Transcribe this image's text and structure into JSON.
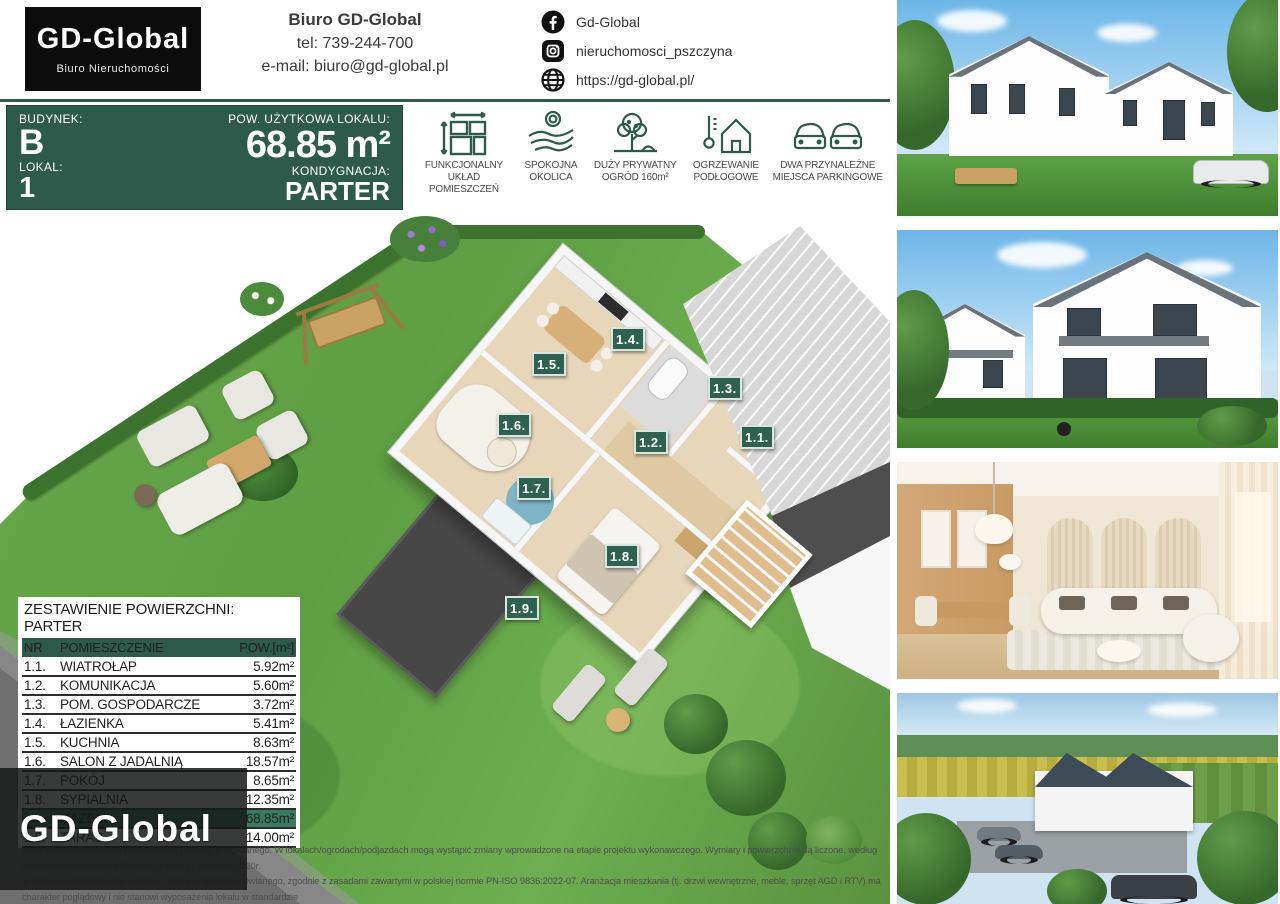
{
  "colors": {
    "brand_green": "#2d5a4a",
    "badge_green": "#2f6150",
    "total_row_green": "#3a7a5f",
    "logo_black": "#0c0c0c"
  },
  "header": {
    "logo": {
      "title": "GD-Global",
      "subtitle": "Biuro Nieruchomości"
    },
    "contact": {
      "company": "Biuro GD-Global",
      "phone": "tel: 739-244-700",
      "email": "e-mail: biuro@gd-global.pl"
    },
    "social": [
      {
        "icon": "facebook-icon",
        "label": "Gd-Global"
      },
      {
        "icon": "instagram-icon",
        "label": "nieruchomosci_pszczyna"
      },
      {
        "icon": "globe-icon",
        "label": "https://gd-global.pl/"
      }
    ]
  },
  "banner": {
    "budynek_label": "BUDYNEK:",
    "budynek_value": "B",
    "lokal_label": "LOKAL:",
    "lokal_value": "1",
    "pow_label": "POW. UŻYTKOWA LOKALU:",
    "pow_value": "68.85 m²",
    "kondygnacja_label": "KONDYGNACJA:",
    "kondygnacja_value": "PARTER"
  },
  "features": [
    {
      "icon": "floor-plan-icon",
      "label": "FUNKCJONALNY\nUKŁAD POMIESZCZEŃ"
    },
    {
      "icon": "calm-area-icon",
      "label": "SPOKOJNA\nOKOLICA"
    },
    {
      "icon": "garden-tree-icon",
      "label": "DUŻY PRYWATNY\nOGRÓD 160m²"
    },
    {
      "icon": "floor-heating-icon",
      "label": "OGRZEWANIE\nPODŁOGOWE"
    },
    {
      "icon": "parking-icon",
      "label": "DWA PRZYNALEŻNE\nMIEJSCA PARKINGOWE"
    }
  ],
  "floorplan": {
    "badges": [
      {
        "label": "1.1.",
        "x": 757,
        "y": 221
      },
      {
        "label": "1.2.",
        "x": 651,
        "y": 226
      },
      {
        "label": "1.3.",
        "x": 725,
        "y": 172
      },
      {
        "label": "1.4.",
        "x": 628,
        "y": 123
      },
      {
        "label": "1.5.",
        "x": 549,
        "y": 148
      },
      {
        "label": "1.6.",
        "x": 514,
        "y": 209
      },
      {
        "label": "1.7.",
        "x": 534,
        "y": 272
      },
      {
        "label": "1.8.",
        "x": 622,
        "y": 340
      },
      {
        "label": "1.9.",
        "x": 522,
        "y": 392
      }
    ]
  },
  "area_table": {
    "title": "ZESTAWIENIE POWIERZCHNI: PARTER",
    "headers": [
      "NR",
      "POMIESZCZENIE",
      "POW.[m²]"
    ],
    "rows": [
      [
        "1.1.",
        "WIATROŁAP",
        "5.92m²"
      ],
      [
        "1.2.",
        "KOMUNIKACJA",
        "5.60m²"
      ],
      [
        "1.3.",
        "POM. GOSPODARCZE",
        "3.72m²"
      ],
      [
        "1.4.",
        "ŁAZIENKA",
        "5.41m²"
      ],
      [
        "1.5.",
        "KUCHNIA",
        "8.63m²"
      ],
      [
        "1.6.",
        "SALON Z JADALNIĄ",
        "18.57m²"
      ],
      [
        "1.7.",
        "POKÓJ",
        "8.65m²"
      ],
      [
        "1.8.",
        "SYPIALNIA",
        "12.35m²"
      ]
    ],
    "total_row": [
      "",
      "RAZEM",
      "68.85m²"
    ],
    "extra_row": [
      "1.9.",
      "TARAS",
      "14.00m²"
    ]
  },
  "watermark": "GD-Global",
  "disclaimer": {
    "line1": "Karta lokalu opracowana na podstawie projektu budowlanego. W lokalach/ogrodach/podjazdach mogą wystąpić zmiany wprowadzone na etapie projektu wykonawczego. Wymiary i powierzchnie są liczone, według rozporządzenia Ministra Rozwoju z dnia 11 września 2020r.",
    "line2": "w sprawie szczegółowego zakresu i formy projektu budowlanego, zgodnie z zasadami zawartymi w polskiej normie PN-ISO 9836:2022-07. Aranżacja mieszkania (tj. drzwi wewnętrzne, meble, sprzęt AGD i RTV) ma charakter poglądowy i nie stanowi wyposażenia lokalu w standardzie",
    "line3": "oferowanym do sprzedaży. Pomiarów pod zakup mebli, urządzeń i wyposażenia należy dokonać z natury, po zakończeniu realizacji."
  },
  "photos": [
    {
      "name": "exterior-front-render"
    },
    {
      "name": "exterior-garden-render"
    },
    {
      "name": "interior-living-render"
    },
    {
      "name": "aerial-estate-render"
    }
  ]
}
